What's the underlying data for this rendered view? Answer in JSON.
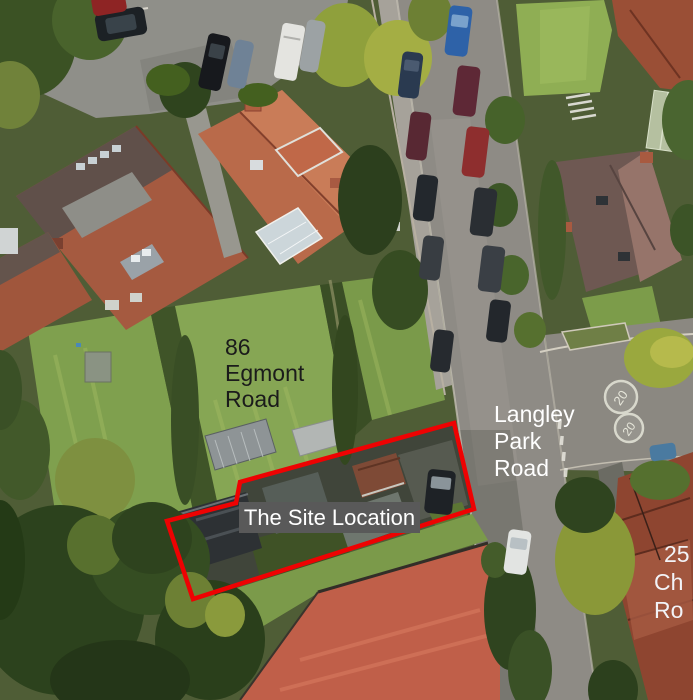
{
  "canvas": {
    "width": 693,
    "height": 700,
    "kind": "aerial site location plan"
  },
  "labels": {
    "house_86": {
      "lines": [
        "86",
        "Egmont",
        "Road"
      ],
      "color": "#1b1b1b"
    },
    "street": {
      "lines": [
        "Langley",
        "Park",
        "Road"
      ],
      "color": "#ffffff"
    },
    "site": {
      "text": "The Site Location",
      "color": "#ffffff",
      "background": "#595959"
    },
    "house_25": {
      "lines": [
        "25",
        "Ch",
        "Ro"
      ],
      "color": "#f2f3f7"
    }
  },
  "site_outline": {
    "points": "240,482 454,423 474,509 193,599 167,521 236,503",
    "stroke_color": "#ee0202",
    "stroke_width": 4.5
  },
  "road_markings": {
    "speed_limit": "20"
  }
}
